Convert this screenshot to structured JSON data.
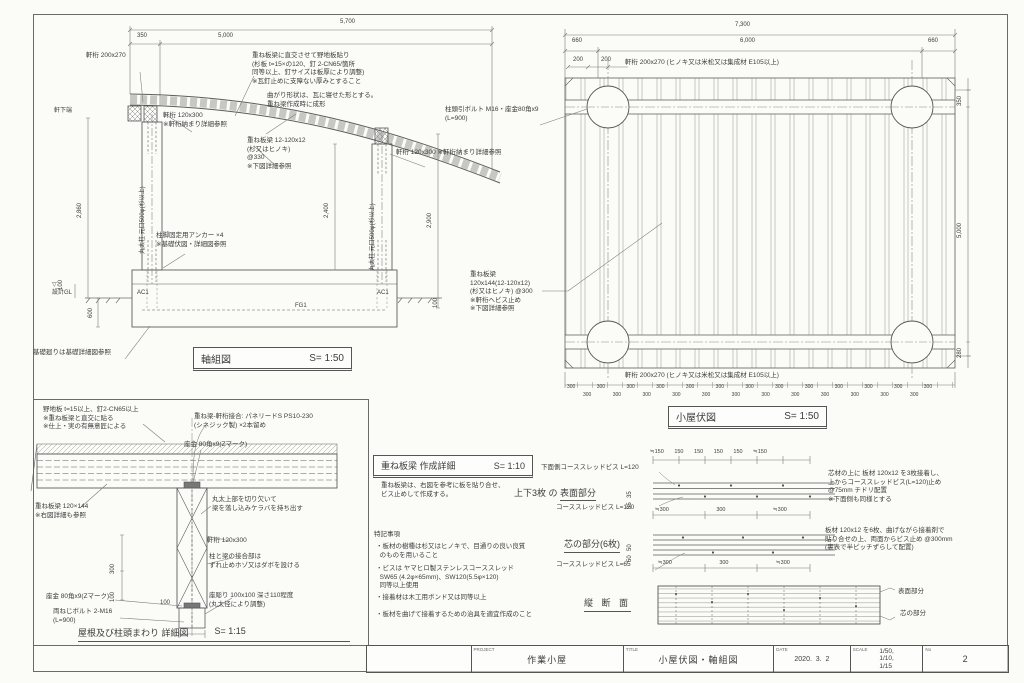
{
  "sheet": {
    "bg": "#fbfbf8",
    "line_color": "#6e6e6e",
    "text_color": "#3c3c3c"
  },
  "elevation": {
    "title": "軸組図",
    "scale": "S= 1:50",
    "dims": {
      "d5700": "5,700",
      "d350": "350",
      "d5000": "5,000",
      "d2860": "2,860",
      "d2400": "2,400",
      "d2900": "2,900",
      "d600": "600",
      "d100l": "100",
      "d100r": "100"
    },
    "labels": {
      "nokigeta200": "軒桁 200x270",
      "nojiita": "重ね板梁に直交させて野地板貼り\n(杉板 t=15×の120、釘 2-CN65/箇所\n同等以上、釘サイズは板厚により調整)\n※瓦釘止めに支障ない厚みとすること",
      "magari": "曲がり形状は、瓦に寝せた形とする。\n重ね梁作成時に成形",
      "kasanebari": "重ね板梁 12-120x12\n(杉又はヒノキ)\n@330\n※下図詳細参照",
      "nokigeta120_left": "軒桁 120x300\n※軒桁納まり詳細参照",
      "nokigeta120_right": "軒桁 120x300 ※軒桁納まり詳細参照",
      "nokishita": "軒下端",
      "hashira_left": "丸太柱 元口500φ(杉以上)",
      "hashira_right": "丸太柱 元口500φ(杉以上)",
      "anchor": "柱脚固定用アンカー ×4\n※基礎伏図・詳細図参照",
      "gl": "▽\n設計GL",
      "fg1": "FG1",
      "ac1_left": "AC1",
      "ac1_right": "AC1",
      "kiso_note": "基礎廻りは基礎詳細図参照"
    }
  },
  "roof_plan": {
    "title": "小屋伏図",
    "scale": "S= 1:50",
    "dims": {
      "d7300": "7,300",
      "d660l": "660",
      "d6000": "6,000",
      "d660r": "660",
      "d200a": "200",
      "d200b": "200",
      "d350": "350",
      "d5000": "5,000",
      "d280": "280",
      "row300_upper": "300 300 300 300 300 300 300 300 300 300 300 300 300",
      "row300_lower": "300 300 300 300 300 300 300 300 300 300 300 300"
    },
    "labels": {
      "nokigeta_top": "軒桁 200x270 (ヒノキ又は米松又は集成材 E105以上)",
      "nokigeta_bottom": "軒桁 200x270 (ヒノキ又は米松又は集成材 E105以上)",
      "bolt": "柱頭引ボルト M16・座金80角x9\n(L=900)",
      "kasanebari": "重ね板梁\n120x144(12-120x12)\n(杉又はヒノキ) @300\n※軒桁へビス止め\n※下図詳細参照"
    }
  },
  "detail": {
    "title": "屋根及び柱頭まわり 詳細図",
    "scale": "S= 1:15",
    "dims": {
      "d300": "300",
      "d100": "100",
      "d100b": "100"
    },
    "labels": {
      "nojiita": "野地板 t=15以上、釘2-CN65以上\n※重ね板梁と直交に貼る\n※仕上・実の有無意匠による",
      "joint": "重ね梁-軒桁接合: パネリードS PS10-230\n(シネジック製) ×2本留め",
      "zagane_top": "座金 80角x9(Zマーク)",
      "maruta": "丸太上部を切り欠いて\n梁を落し込みケラバを持ち出す",
      "kasanebari": "重ね板梁 120×144\n※右図詳細も参照",
      "nokigeta": "軒桁 120x300",
      "hozo": "柱と梁の接合部は\nずれ止めホゾ又はダボを設ける",
      "zabori": "座彫り 100x100 深さ110程度\n(丸太径により調整)",
      "zagane_bottom": "座金 80角x9(Zマーク)",
      "bolt": "両ねじボルト 2-M16\n(L=900)"
    }
  },
  "beam_spec": {
    "title": "重ね板梁 作成詳細",
    "scale": "S= 1:10",
    "intro": "重ね板梁は、右図を参考に板を貼り合せ、\nビス止めして作成する。",
    "notes_title": "特記事項",
    "notes": [
      "・板材の樹種は杉又はヒノキで、目通りの良い良質\n  のものを用いること",
      "・ビスは ヤマヒロ製ステンレスコーススレッド\n  SW65 (4.2φ×65mm)、SW120(5.5φ×120)\n  同等以上使用",
      "・接着材は木工用ボンド又は同等以上",
      "・板材を曲げて接着するための治具を適宜作成のこと"
    ]
  },
  "screw_layout": {
    "label_bottom_screw": "下面側コーススレッドビス L=120",
    "heading_surface_1": "上下3枚 の ",
    "heading_surface_2": "表面部分",
    "label_screw120": "コーススレッドビス L=120",
    "heading_core": "芯の部分(6枚)",
    "label_screw65": "コーススレッドビス L=65",
    "dims_top": "≒150 150 150 150 150 ≒150",
    "dims_mid": "≒300 300 ≒300",
    "dims_bottom": "≒300 300 ≒300",
    "dim_35a": "35",
    "dim_35b": "35",
    "dim_50a": "50",
    "dim_50b": "50",
    "section_title": "縦 断 面",
    "label_surface": "表面部分",
    "label_core": "芯の部分",
    "note_surface": "芯材の上に 板材 120x12 を3枚接着し、\n上からコーススレッドビス(L=120)止め\n@75mm チドリ配置\n※下面側も同様とする",
    "note_core": "板材 120x12 を6枚、曲げながら接着剤で\n貼り合せの上、両面からビス止め @300mm\n(裏表で半ピッチずらして配置)"
  },
  "title_block": {
    "project_label": "PROJECT",
    "project": "作業小屋",
    "title_label": "TITLE",
    "title": "小屋伏図・軸組図",
    "date_label": "DATE",
    "date": "2020.  3.  2",
    "scale_label": "SCALE",
    "scales": "1/50,\n1/10,\n1/15",
    "no_label": "No",
    "no": "2"
  }
}
